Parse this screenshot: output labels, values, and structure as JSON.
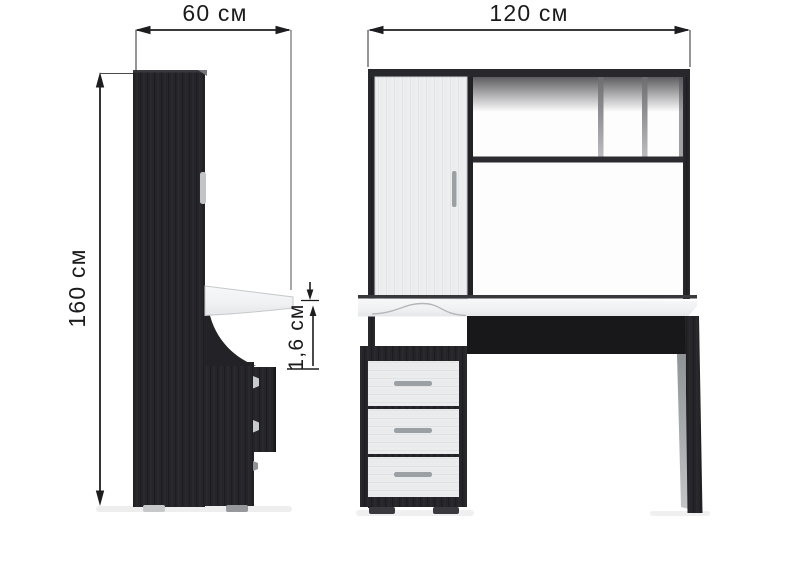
{
  "diagram": {
    "kind": "furniture dimension diagram",
    "views": [
      "side",
      "front"
    ]
  },
  "dimensions": {
    "side_width": "60 см",
    "front_width": "120 см",
    "height": "160 см",
    "desktop_thickness": "1,6 см"
  },
  "colors": {
    "background": "#ffffff",
    "dark_wood": "#26262a",
    "light_wood": "#edeef0",
    "desktop_white": "#f4f5f6",
    "handle_gray": "#9aa0a4",
    "dimension_ink": "#1d1d1f"
  }
}
